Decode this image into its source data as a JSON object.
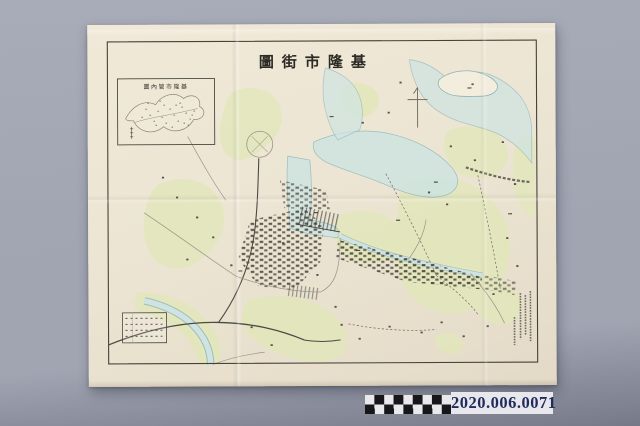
{
  "map": {
    "title_display": "圖街市隆基",
    "title_reading": "基隆市街圖",
    "inset_title_display": "圖內管市隆基",
    "inset_title_reading": "基隆市管內圖",
    "colophon_line_count": 4
  },
  "legend": {
    "rows": 4,
    "columns": 8
  },
  "scale_bar": {
    "rows": 2,
    "columns": 9
  },
  "catalog": {
    "number": "2020.006.0071"
  },
  "colors": {
    "paper": "#ece5d3",
    "frame": "#45423a",
    "ink": "#3d3a33",
    "water_fill": "#cfe4e2",
    "water_stroke": "#8fb3ba",
    "land_tint": "#e2e7ba",
    "road": "#9b9489",
    "rail": "#4d4a43",
    "catalog_text": "#202c5c",
    "catalog_bg": "#e7e7ec",
    "checker_dark": "#17171a",
    "checker_light": "#e9e9ec",
    "bg_top": "#a8acb8",
    "bg_mid": "#a1a5b2",
    "bg_bottom": "#767a89"
  }
}
